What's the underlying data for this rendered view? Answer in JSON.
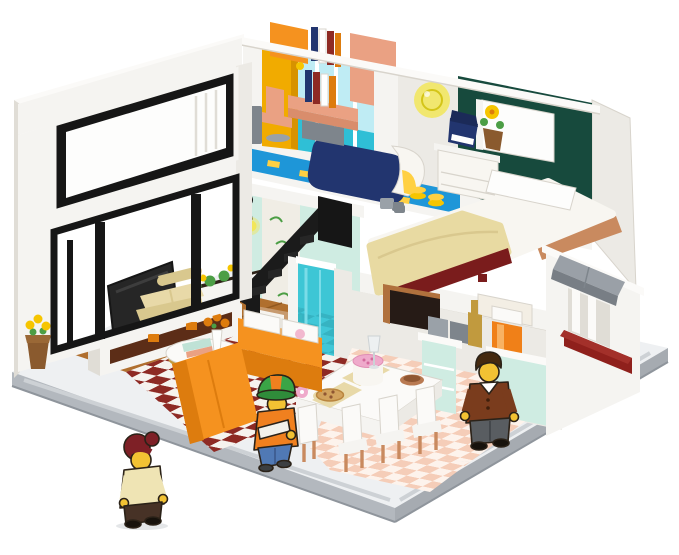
{
  "scene": {
    "description": "Isometric cutaway photo of a brick-built two-story modern house play set with furnished rooms and three cartoon minifigures on a light gray baseplate, white background",
    "style": "building-brick model, dollhouse cutaway view",
    "background": "#ffffff"
  },
  "palette": {
    "bg": "#ffffff",
    "base_top": "#eef0f2",
    "base_side": "#b3b8be",
    "base_side2": "#a6abb1",
    "base_stripe": "#cdd1d5",
    "base_edge": "#8f959c",
    "wall": "#f5f4f1",
    "wall2": "#eceae5",
    "wall_shade": "#e0ddd6",
    "cap": "#fbfaf8",
    "line": "#d8d4cc",
    "black": "#161616",
    "glass": "#fdfdfc",
    "yellow_wall": "#f1ab00",
    "yellow_wall2": "#d79200",
    "teal_pale": "#bfecf4",
    "teal": "#2fbfd6",
    "teal_deep": "#149fc0",
    "blue_floor": "#1e96d8",
    "tile_yellow": "#ffd042",
    "navy": "#22356f",
    "navy2": "#1b2a58",
    "green_wall": "#174a3d",
    "salmon": "#eaa183",
    "salmon2": "#d98d6c",
    "bed_white": "#f8f6f1",
    "blanket": "#e8daa2",
    "bed_red": "#7a1c1c",
    "nougat": "#c98a5f",
    "wood": "#b06f2e",
    "wood_dark": "#91581f",
    "checker_red": "#8e2a24",
    "checker_white": "#f6f3ee",
    "mint": "#cfece2",
    "mint2": "#bfe2d6",
    "leaf_panel": "#f0ede5",
    "green_leaf": "#4c9e45",
    "flower_yellow": "#f6c500",
    "pot": "#8a5a2e",
    "shower": "#2cc2d4",
    "shower2": "#7adce8",
    "pink_tile": "#f5cdb8",
    "pink_white": "#fdf3ec",
    "orange": "#f5921f",
    "orange2": "#dd7c0e",
    "tan": "#e8d9a8",
    "tan2": "#d9c88e",
    "tv": "#262626",
    "shelf": "#5c2d17",
    "gold": "#c19a3e",
    "wood_frame": "#b0713d",
    "dark_open": "#261b16",
    "awning": "#9aa0a7",
    "awning2": "#787e85",
    "red_box": "#8f201c",
    "cake_pink": "#efaacb",
    "pizza": "#d2a35e",
    "pizza_edge": "#b9853e",
    "bowl": "#b97a52",
    "bowl2": "#8f5632",
    "gray1": "#9aa1a8",
    "gray2": "#7e858c",
    "juice": "#f08018",
    "juice2": "#f8b263",
    "lamp": "#f2e65a",
    "lamp_ring": "#d4c518",
    "skin": "#f2c233",
    "outline": "#2b2218",
    "f1_hair": "#7e2026",
    "f1_top": "#efe4b4",
    "f1_pants": "#473226",
    "shoe": "#17120c",
    "f2_cap": "#3aa546",
    "f2_cap2": "#2f8c3a",
    "f2_orange": "#f0801f",
    "f2_jeans": "#5079b5",
    "f2_shoe": "#3c3f42",
    "f3_hair": "#45290f",
    "f3_coat": "#7a3c1d",
    "f3_pants": "#595d61",
    "white": "#ffffff"
  },
  "exterior": {
    "baseplate": "light gray plate with white platform and gray edge stripes",
    "left_wall": [
      "white parapet cap",
      "horizontal picture window with black inner frame",
      "floor-to-ceiling black-framed glazing with mullions"
    ],
    "right_wall": [
      "gray awning",
      "white slatted window",
      "dark red planter box"
    ],
    "roof": "flat white roof edges"
  },
  "rooms": {
    "study": {
      "name": "upstairs study",
      "items": [
        "yellow accent wall",
        "teal window wall",
        "salmon wall cabinet",
        "salmon desk and swivel chair",
        "row of books",
        "gray waste bin",
        "orange cupboard",
        "blue floor"
      ]
    },
    "bathroom_up": {
      "name": "upstairs bathroom",
      "items": [
        "bright blue floor with yellow tiles",
        "navy bathtub with white end",
        "gray faucet set"
      ]
    },
    "bedroom": {
      "name": "upstairs bedroom",
      "items": [
        "dark green wall",
        "white window",
        "round yellow wall light",
        "white bed with cream blanket and pillow",
        "dark red bed base",
        "white nightstand",
        "navy typewriter",
        "flower pot with yellow flower",
        "yellow coin stacks",
        "gray gadgets",
        "warm tan floor strip"
      ]
    },
    "living_room": {
      "name": "living room",
      "items": [
        "mint leaf wallpaper",
        "black wall lamp with yellow glow",
        "black staircase",
        "framed posters",
        "white TV stand with dark wood shelf",
        "black television",
        "cream telephone",
        "tan loveseat",
        "round coffee table with gold legs",
        "vase with orange flowers",
        "mint and salmon books",
        "orange sectional sofa with white cushions",
        "wood plank floor",
        "red and white checkered tiles",
        "hanging greenery with yellow flowers"
      ]
    },
    "shower_room": {
      "name": "downstairs shower room",
      "items": [
        "teal glass shower panel",
        "white partition walls"
      ]
    },
    "dining_kitchen": {
      "name": "dining room and kitchen",
      "items": [
        "pink checkered tile floor",
        "white dining table",
        "pink cream cake",
        "pizza on plate",
        "brown bowl",
        "wine glass",
        "pink donut",
        "white chairs with nougat legs",
        "mint cabinet with drawers",
        "gray toasters",
        "gold bottle",
        "orange juice dispenser",
        "mint kitchen island",
        "dark pass-through window with wood frame",
        "white upper cabinets"
      ]
    }
  },
  "figures": [
    {
      "id": "woman",
      "pose": "walking outside near front-left corner",
      "hair": "dark red with bun",
      "top": "cream long-sleeve",
      "bottom": "dark brown pants",
      "shoes": "black"
    },
    {
      "id": "kid",
      "pose": "standing in living room by sofa",
      "hat": "green cap with orange panels",
      "top": "orange hoodie with white arm cast",
      "bottom": "blue jeans",
      "shoes": "dark gray"
    },
    {
      "id": "man",
      "pose": "standing in kitchen by counter",
      "hair": "brown",
      "top": "brown cardigan with white collar",
      "bottom": "gray trousers",
      "shoes": "black"
    }
  ],
  "plants": [
    {
      "id": "outdoor-pot",
      "desc": "brown pot with yellow flowers outside the glass wall"
    },
    {
      "id": "ledge-greenery",
      "desc": "green vines with yellow flowers on living room ledge"
    },
    {
      "id": "bedroom-pot",
      "desc": "potted yellow flower on nightstand"
    }
  ]
}
